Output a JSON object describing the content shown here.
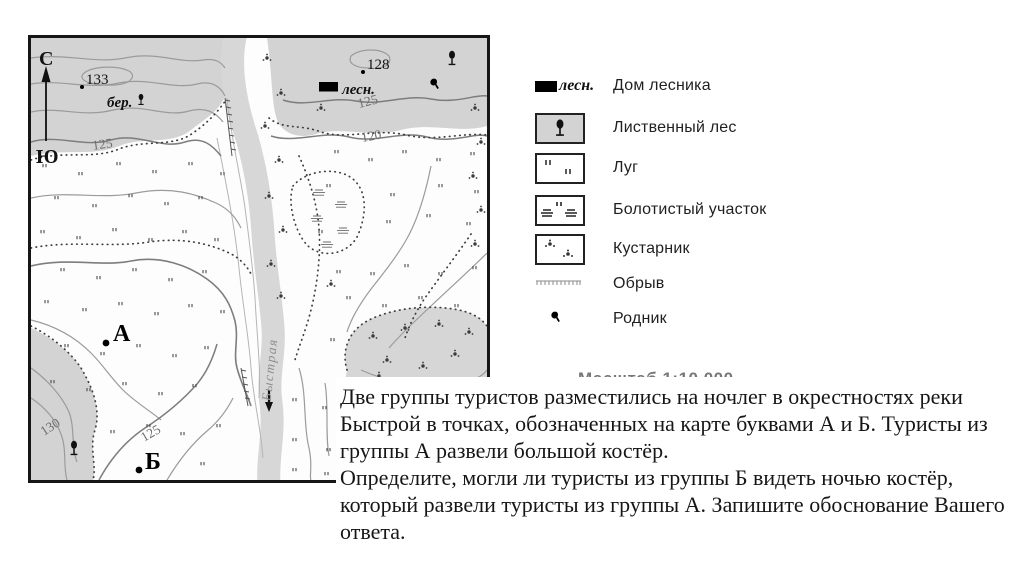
{
  "map": {
    "compass": {
      "north": "С",
      "south": "Ю"
    },
    "labels": {
      "elev_133": "133",
      "elev_128": "128",
      "birch": "бер.",
      "forester": "лесн.",
      "contour_125_left": "125",
      "contour_125_right": "125",
      "contour_125_bottom": "125",
      "contour_120": "120",
      "contour_130": "130",
      "river_name": "Быстрая",
      "point_a": "А",
      "point_b": "Б"
    }
  },
  "legend": {
    "items": [
      {
        "symbol": "forester-house",
        "symbol_label": "лесн.",
        "label": "Дом лесника"
      },
      {
        "symbol": "deciduous-forest",
        "label": "Лиственный лес"
      },
      {
        "symbol": "meadow",
        "label": "Луг"
      },
      {
        "symbol": "swamp",
        "label": "Болотистый участок"
      },
      {
        "symbol": "shrub",
        "label": "Кустарник"
      },
      {
        "symbol": "cliff",
        "label": "Обрыв"
      },
      {
        "symbol": "spring",
        "label": "Родник"
      }
    ],
    "scale_text": "Масштаб 1:10 000"
  },
  "question": {
    "paragraph1": "Две группы туристов разместились на ночлег в окрестностях реки Быстрой в точках, обозначенных на карте буквами А и Б. Туристы из группы А развели большой костёр.",
    "paragraph2": "Определите, могли ли туристы из группы Б видеть ночью костёр, который развели туристы из группы А. Запишите обоснование Вашего ответа."
  },
  "colors": {
    "forest_fill": "#d3d3d3",
    "river_fill": "#d7d7d7",
    "contour": "#9b9b9b",
    "ink": "#161616"
  }
}
